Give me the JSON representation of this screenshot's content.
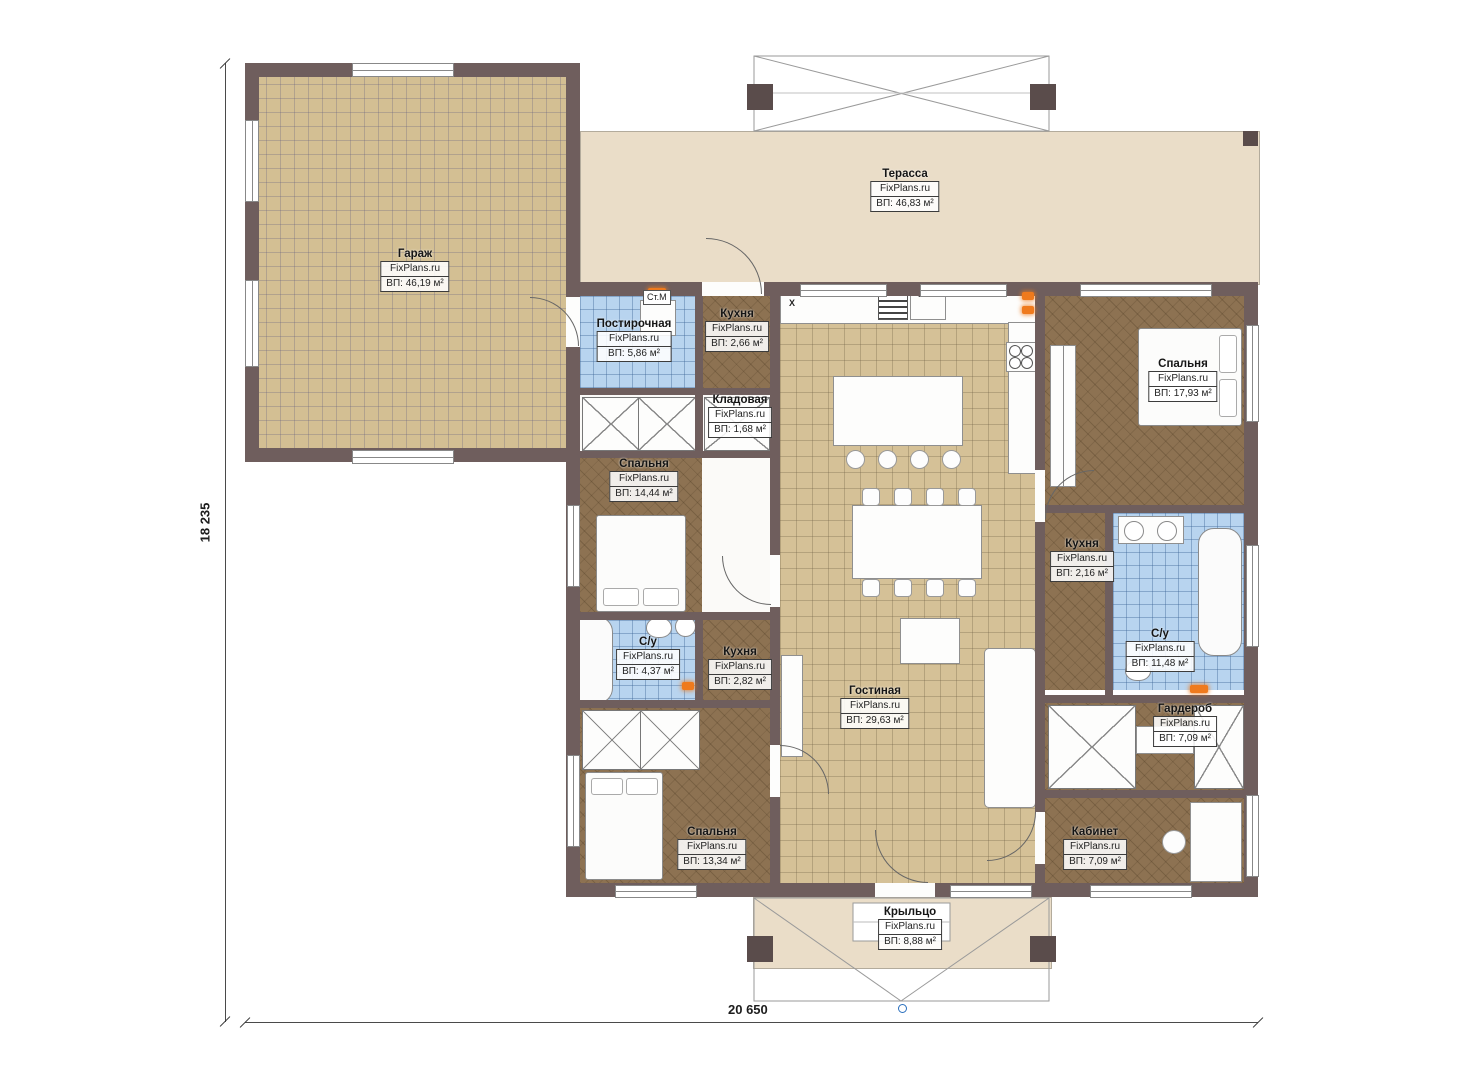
{
  "plan": {
    "brand": "FixPlans.ru",
    "dim_width": "20 650",
    "dim_height": "18 235",
    "washer_label": "Ст.М",
    "vent_label": "X"
  },
  "colors": {
    "wall": "#6f5e5d",
    "tile_floor": "#d5c197",
    "wood_floor": "#8d7252",
    "bath_floor": "#b8d4ef",
    "terrace_floor": "#eaddc8",
    "radiator": "#ef7a1d"
  },
  "rooms": [
    {
      "name": "Гараж",
      "area": "ВП: 46,19 м²"
    },
    {
      "name": "Терасса",
      "area": "ВП: 46,83 м²"
    },
    {
      "name": "Постирочная",
      "area": "ВП: 5,86 м²"
    },
    {
      "name": "Кухня",
      "area": "ВП: 2,66 м²"
    },
    {
      "name": "Кладовая",
      "area": "ВП: 1,68 м²"
    },
    {
      "name": "Спальня",
      "area": "ВП: 14,44 м²"
    },
    {
      "name": "Спальня",
      "area": "ВП: 17,93 м²"
    },
    {
      "name": "Кухня",
      "area": "ВП: 2,16 м²"
    },
    {
      "name": "С/у",
      "area": "ВП: 4,37 м²"
    },
    {
      "name": "Кухня",
      "area": "ВП: 2,82 м²"
    },
    {
      "name": "Гостиная",
      "area": "ВП: 29,63 м²"
    },
    {
      "name": "С/у",
      "area": "ВП: 11,48 м²"
    },
    {
      "name": "Гардероб",
      "area": "ВП: 7,09 м²"
    },
    {
      "name": "Спальня",
      "area": "ВП: 13,34 м²"
    },
    {
      "name": "Кабинет",
      "area": "ВП: 7,09 м²"
    },
    {
      "name": "Крыльцо",
      "area": "ВП: 8,88 м²"
    }
  ]
}
